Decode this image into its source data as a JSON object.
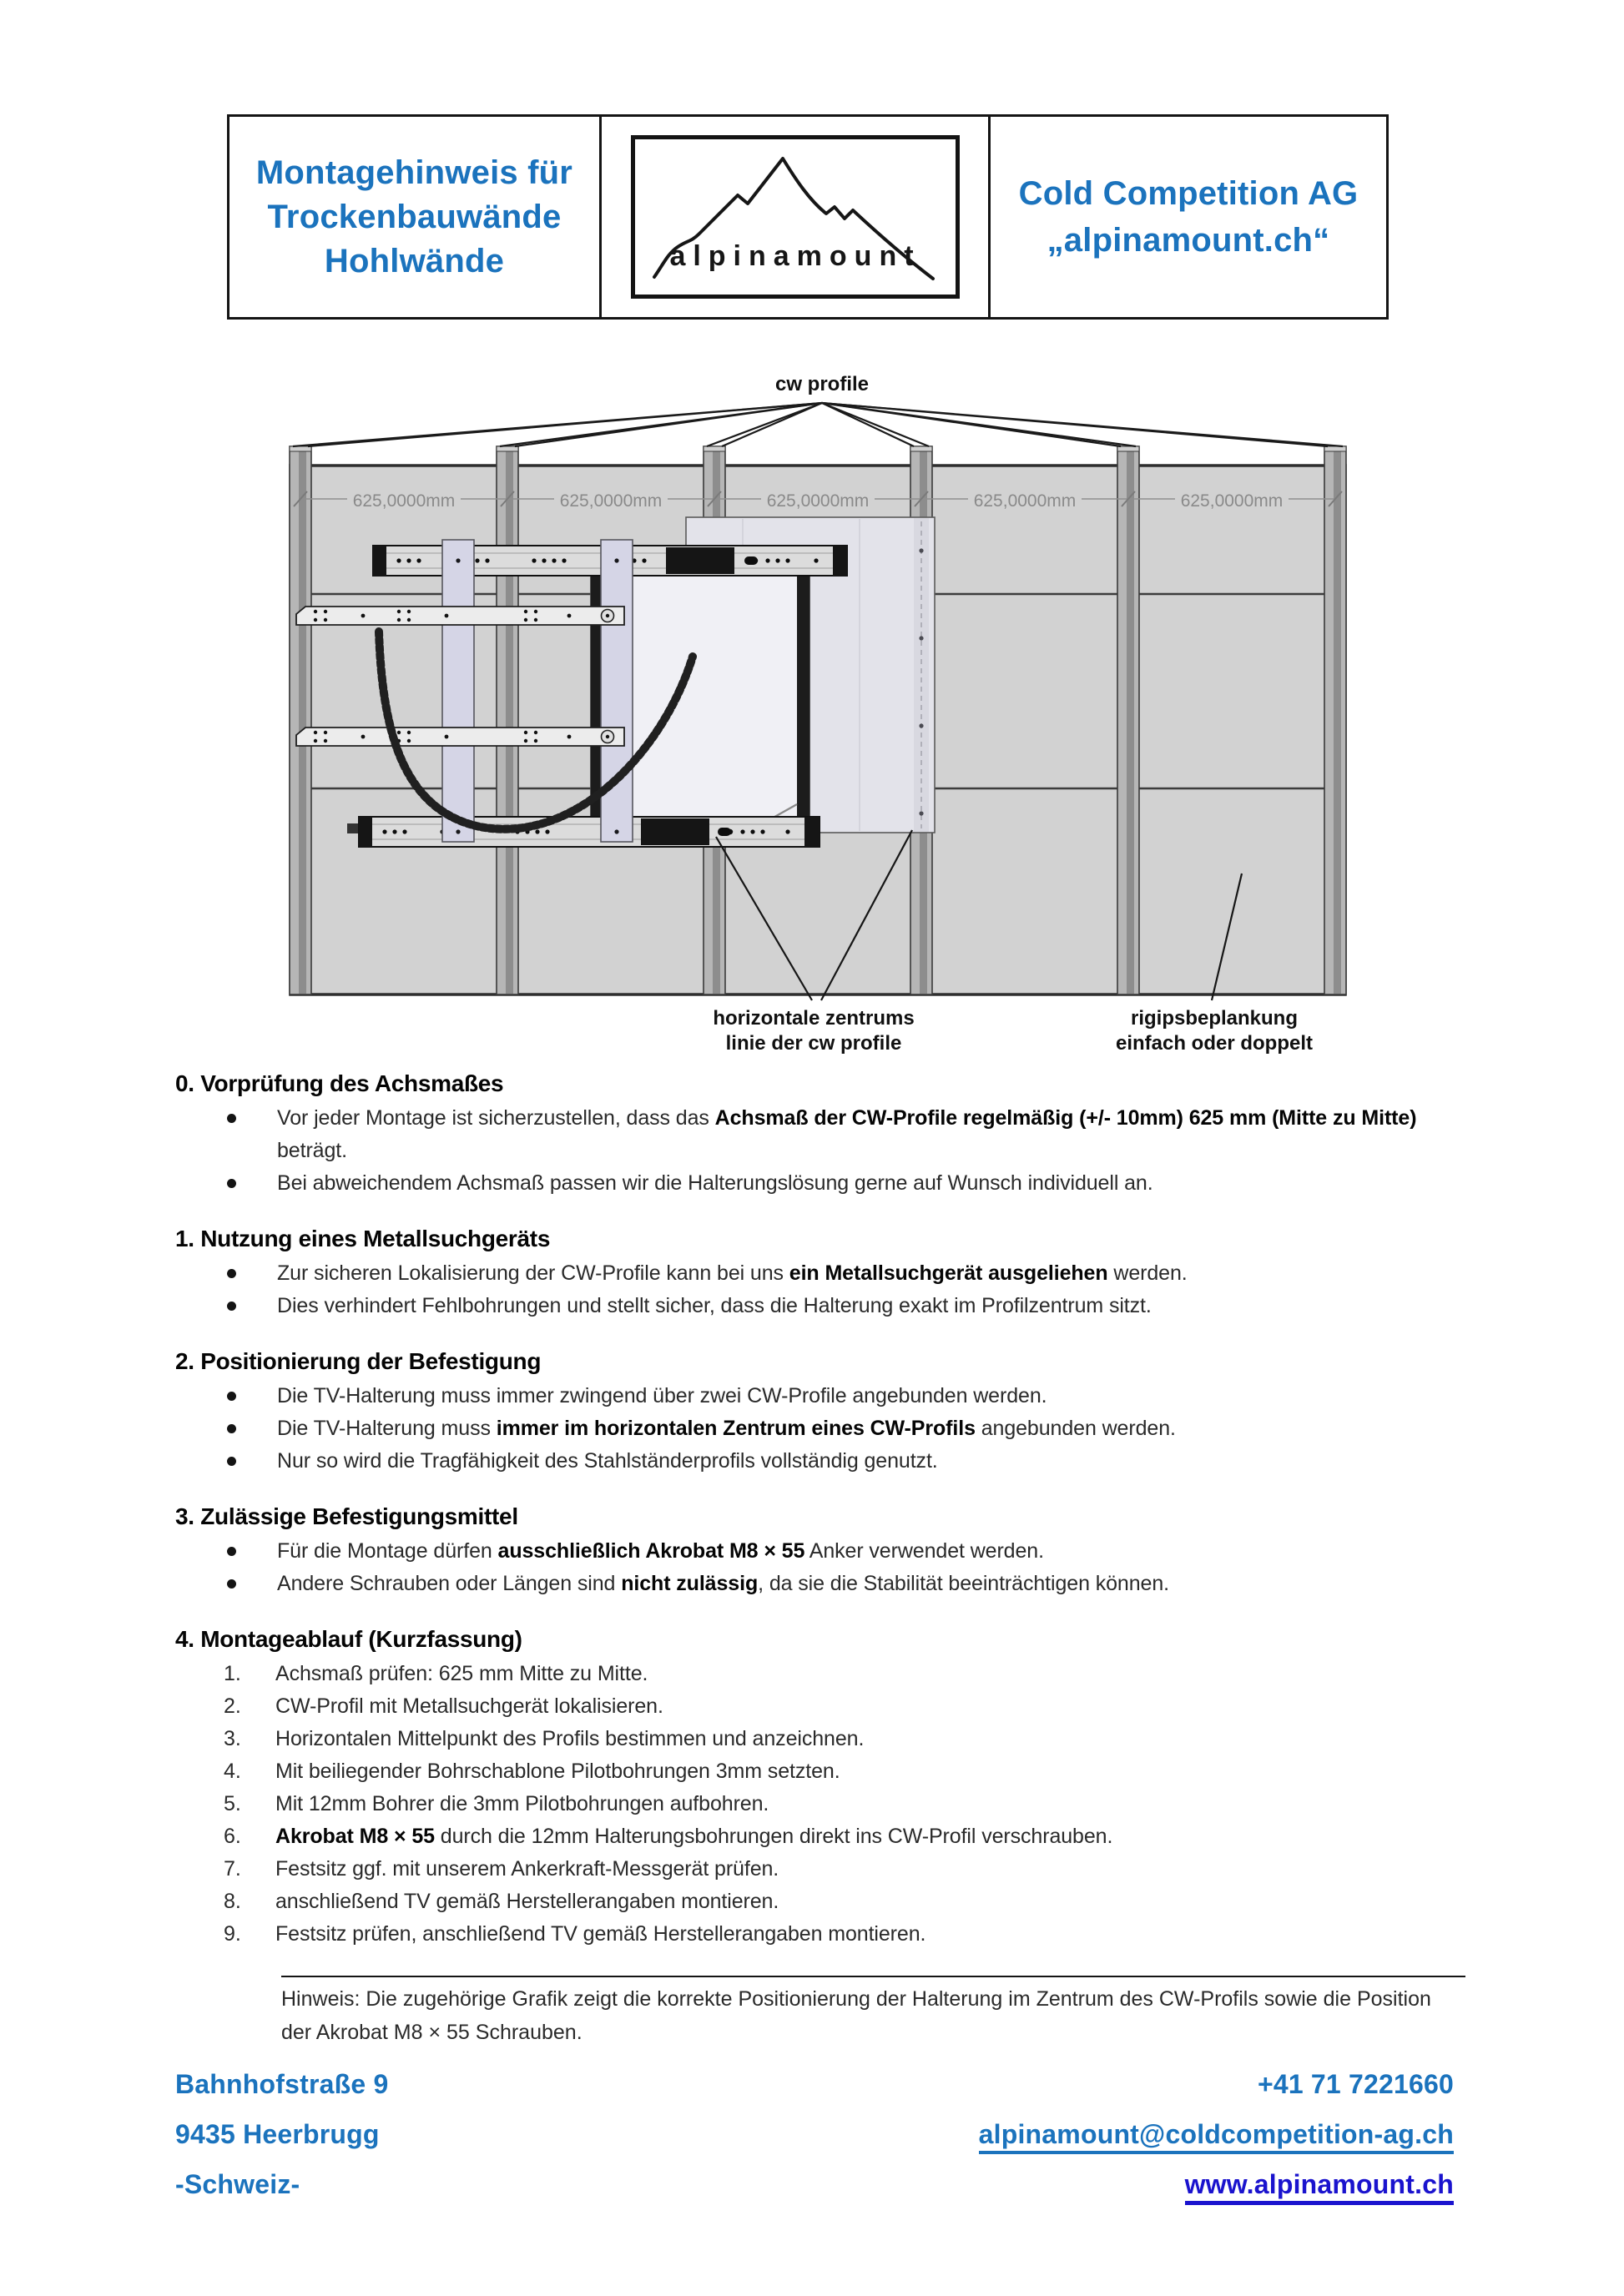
{
  "colors": {
    "brand_blue": "#1b73bd",
    "link_blue": "#1a13ce",
    "wall_gray": "#d2d2d2",
    "dim_gray": "#8a8a8a"
  },
  "header": {
    "title_lines": [
      "Montagehinweis für",
      "Trockenbauwände",
      "Hohlwände"
    ],
    "logo_text": "alpinamount",
    "company_lines": [
      "Cold Competition AG",
      "„alpinamount.ch“"
    ]
  },
  "diagram": {
    "top_label": "cw profile",
    "dim_labels": [
      "625,0000mm",
      "625,0000mm",
      "625,0000mm",
      "625,0000mm",
      "625,0000mm"
    ],
    "center_label": [
      "horizontale zentrums",
      "linie der cw profile"
    ],
    "board_label": [
      "rigipsbeplankung",
      "einfach oder doppelt"
    ]
  },
  "sections": [
    {
      "heading": "0. Vorprüfung des Achsmaßes",
      "list_type": "bullet",
      "items": [
        {
          "runs": [
            {
              "text": "Vor jeder Montage ist sicherzustellen, dass das "
            },
            {
              "text": "Achsmaß der CW-Profile regelmäßig (+/- 10mm) 625 mm (Mitte zu Mitte)",
              "bold": true
            },
            {
              "text": " beträgt."
            }
          ]
        },
        {
          "runs": [
            {
              "text": "Bei abweichendem Achsmaß passen wir die Halterungslösung gerne auf Wunsch individuell an."
            }
          ]
        }
      ]
    },
    {
      "heading": "1. Nutzung eines Metallsuchgeräts",
      "list_type": "bullet",
      "items": [
        {
          "runs": [
            {
              "text": "Zur sicheren Lokalisierung der CW-Profile kann bei uns "
            },
            {
              "text": "ein Metallsuchgerät ausgeliehen",
              "bold": true
            },
            {
              "text": " werden."
            }
          ]
        },
        {
          "runs": [
            {
              "text": "Dies verhindert Fehlbohrungen und stellt sicher, dass die Halterung exakt im Profilzentrum sitzt."
            }
          ]
        }
      ]
    },
    {
      "heading": "2. Positionierung der Befestigung",
      "list_type": "bullet",
      "items": [
        {
          "runs": [
            {
              "text": "Die TV-Halterung muss immer zwingend über zwei CW-Profile angebunden werden."
            }
          ]
        },
        {
          "runs": [
            {
              "text": "Die TV-Halterung muss "
            },
            {
              "text": "immer im horizontalen Zentrum eines CW-Profils",
              "bold": true
            },
            {
              "text": " angebunden werden."
            }
          ]
        },
        {
          "runs": [
            {
              "text": "Nur so wird die Tragfähigkeit des Stahlständerprofils vollständig genutzt."
            }
          ]
        }
      ]
    },
    {
      "heading": "3. Zulässige Befestigungsmittel",
      "list_type": "bullet",
      "items": [
        {
          "runs": [
            {
              "text": "Für die Montage dürfen "
            },
            {
              "text": "ausschließlich Akrobat M8 × 55",
              "bold": true
            },
            {
              "text": " Anker verwendet werden."
            }
          ]
        },
        {
          "runs": [
            {
              "text": "Andere Schrauben oder Längen sind "
            },
            {
              "text": "nicht zulässig",
              "bold": true
            },
            {
              "text": ", da sie die Stabilität beeinträchtigen können."
            }
          ]
        }
      ]
    },
    {
      "heading": "4. Montageablauf (Kurzfassung)",
      "list_type": "numbered",
      "items": [
        {
          "runs": [
            {
              "text": "Achsmaß prüfen: 625 mm Mitte zu Mitte."
            }
          ]
        },
        {
          "runs": [
            {
              "text": "CW-Profil mit Metallsuchgerät lokalisieren."
            }
          ]
        },
        {
          "runs": [
            {
              "text": "Horizontalen Mittelpunkt des Profils bestimmen und anzeichnen."
            }
          ]
        },
        {
          "runs": [
            {
              "text": "Mit beiliegender Bohrschablone Pilotbohrungen 3mm setzten."
            }
          ]
        },
        {
          "runs": [
            {
              "text": "Mit 12mm Bohrer die 3mm Pilotbohrungen aufbohren."
            }
          ]
        },
        {
          "runs": [
            {
              "text": "Akrobat M8 × 55",
              "bold": true
            },
            {
              "text": " durch die 12mm Halterungsbohrungen direkt ins CW-Profil verschrauben."
            }
          ]
        },
        {
          "runs": [
            {
              "text": "Festsitz ggf. mit unserem Ankerkraft-Messgerät prüfen."
            }
          ]
        },
        {
          "runs": [
            {
              "text": "anschließend TV gemäß Herstellerangaben montieren."
            }
          ]
        },
        {
          "runs": [
            {
              "text": "Festsitz prüfen, anschließend TV gemäß Herstellerangaben montieren."
            }
          ]
        }
      ]
    }
  ],
  "note": {
    "text": "Hinweis: Die zugehörige Grafik zeigt die korrekte Positionierung der Halterung im Zentrum des CW-Profils sowie die Position der Akrobat M8 × 55 Schrauben."
  },
  "footer": {
    "address_lines": [
      "Bahnhofstraße 9",
      "9435 Heerbrugg",
      "-Schweiz-"
    ],
    "phone": "+41 71 7221660",
    "email": "alpinamount@coldcompetition-ag.ch",
    "website": "www.alpinamount.ch"
  }
}
